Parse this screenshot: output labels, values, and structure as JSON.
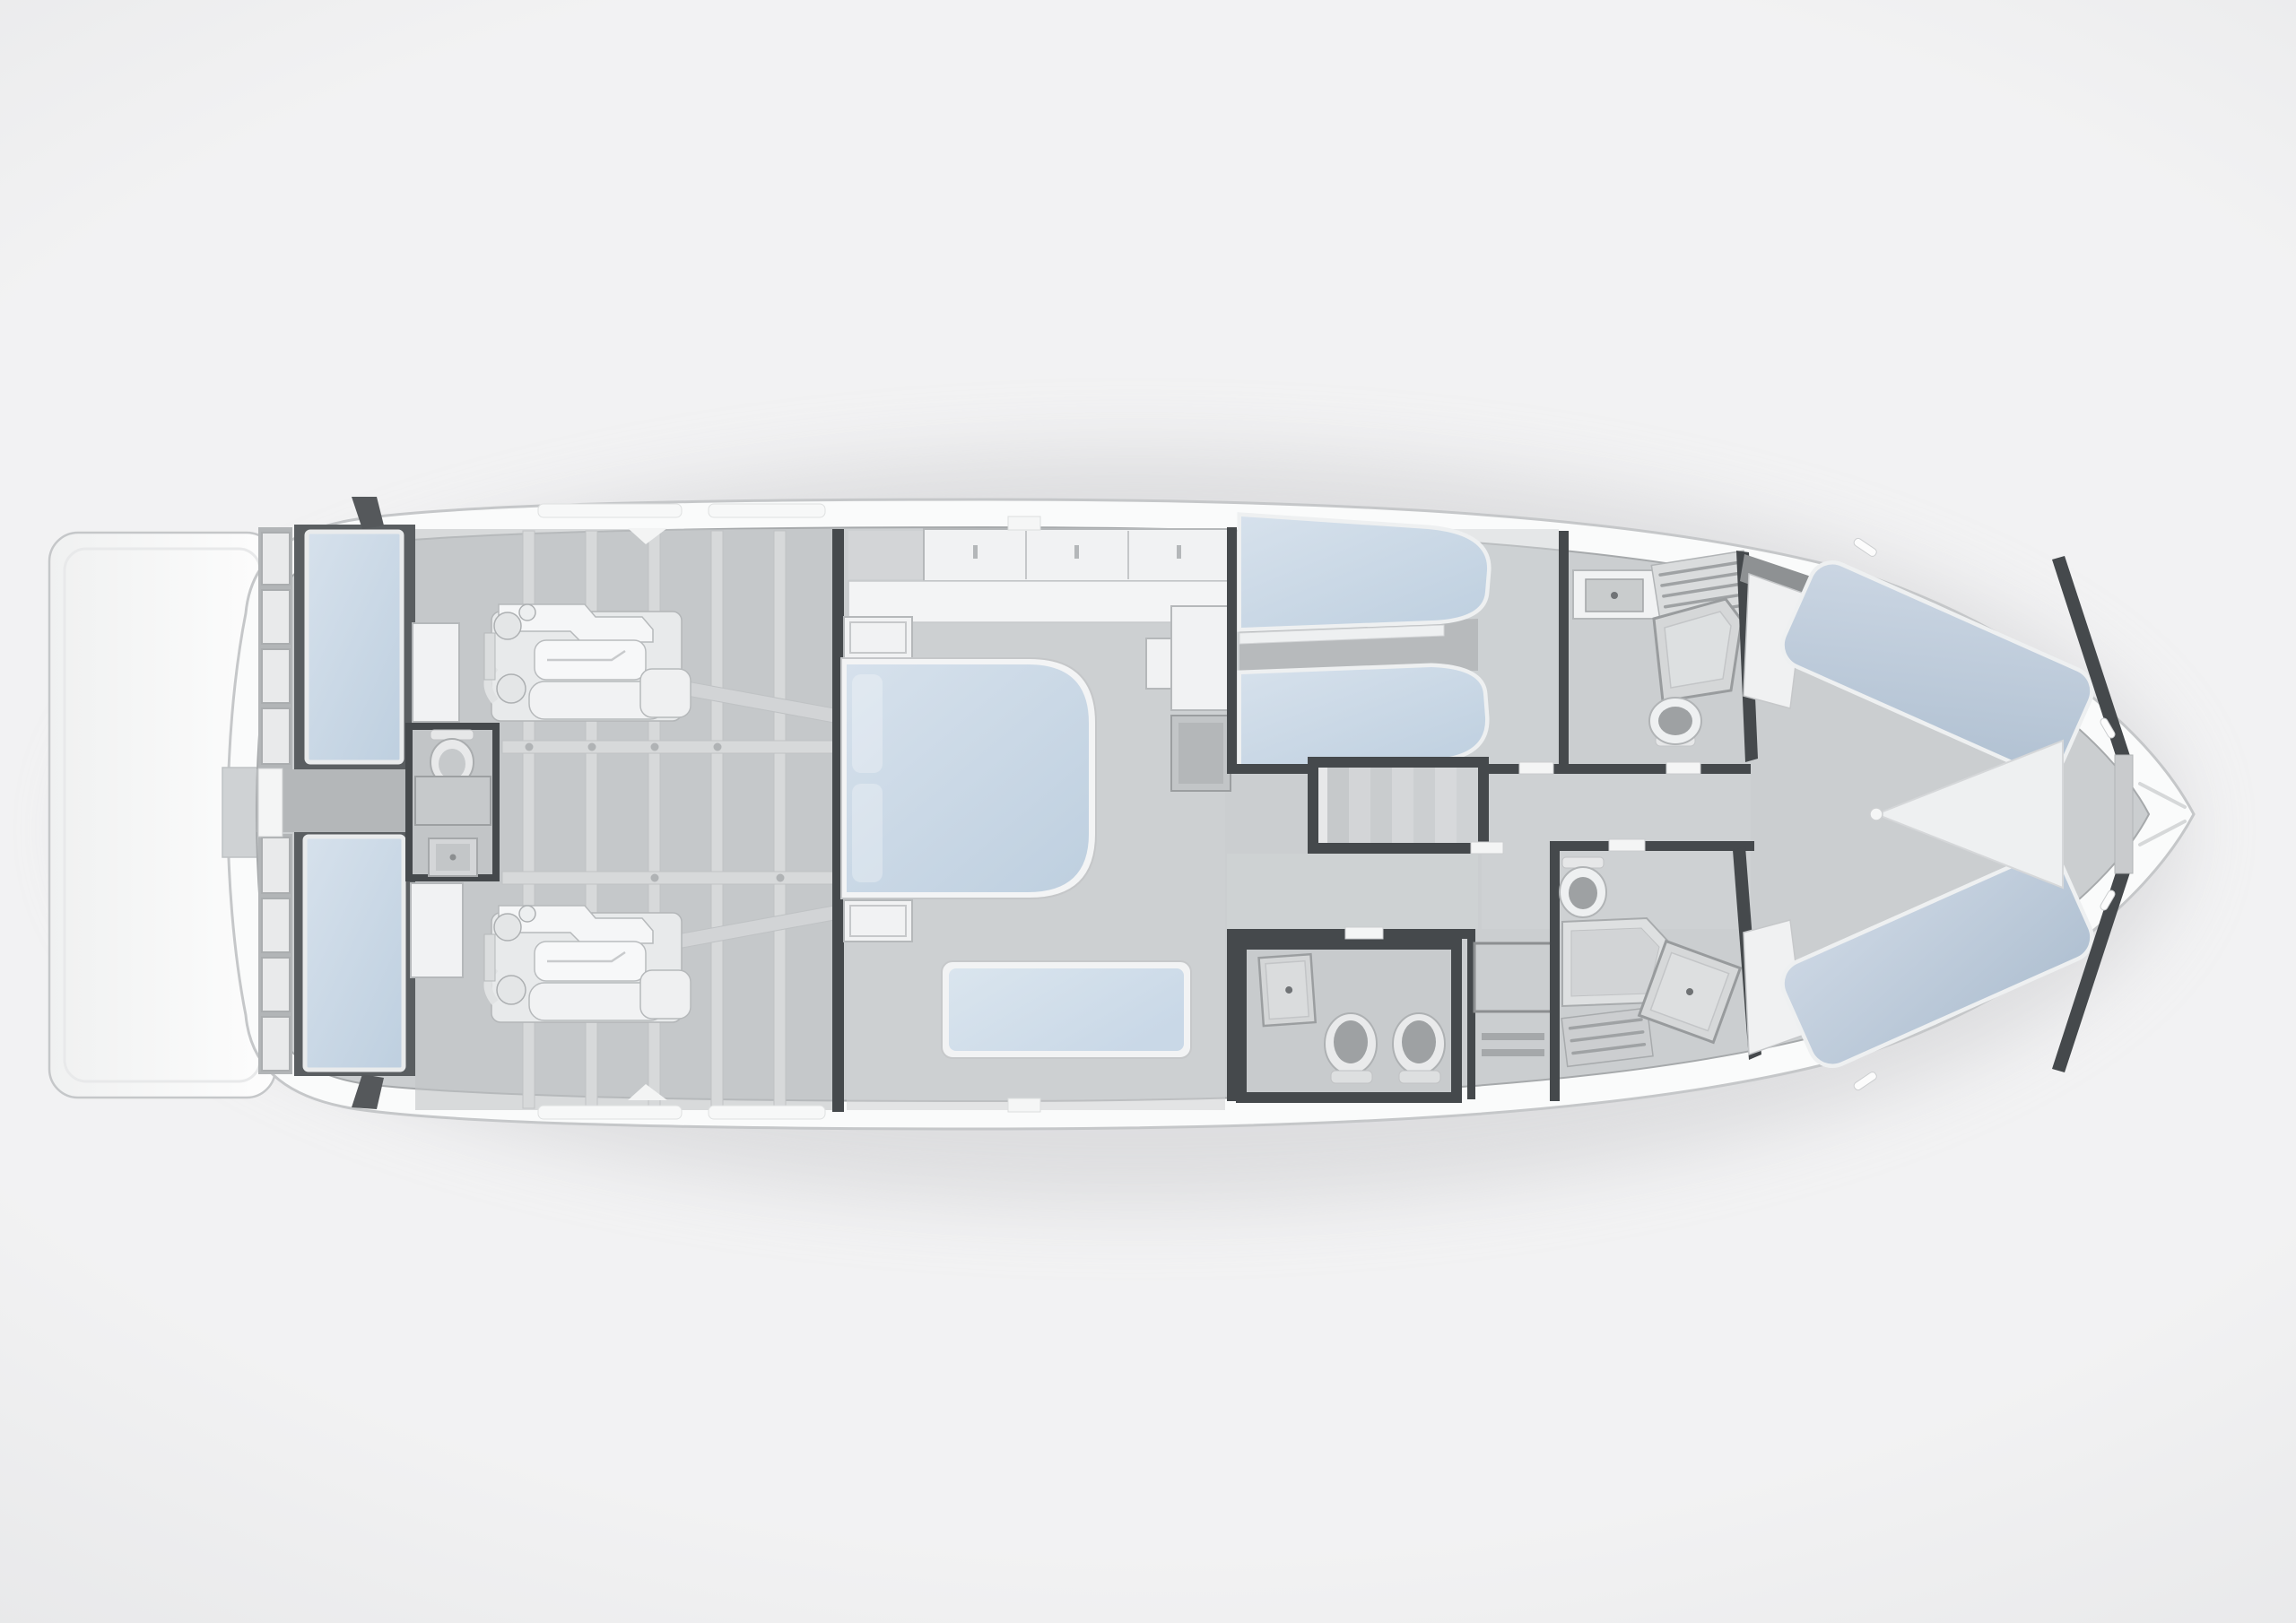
{
  "meta": {
    "title": "Yacht lower deck floor plan — top view",
    "view": "top-down cutaway render",
    "orientation": "bow pointing right, stern (swim platform) at left"
  },
  "palette": {
    "bg-center": "#f2f2f3",
    "bg-edge": "#dbdcde",
    "hull": "#fafbfb",
    "hull-outline": "#c5c7c9",
    "floor": "#cbced0",
    "floor-dark": "#b4b7b9",
    "beam": "#d7d9da",
    "wall": "#45494c",
    "furn": "#f1f2f3",
    "furn-line": "#b5b8ba",
    "door": "#f4f5f5",
    "mat-light": "#d6e1ec",
    "mat-dark": "#bfd0e0",
    "vip-light": "#cbd6e3",
    "vip-dark": "#b2c2d3",
    "sofa-light": "#dae5ee",
    "sofa-dark": "#c9d8e7",
    "fix": "#e9eaeb",
    "fix-dark": "#9ea1a3",
    "shadow": "#cdced0"
  },
  "plan": {
    "stern_to_bow": [
      "swim-platform",
      "crew-area",
      "engine-room",
      "master-cabin",
      "twin-cabin",
      "staircase",
      "corridor",
      "guest-bathroom",
      "utility-compartment",
      "twin-bathroom",
      "vip-bathroom",
      "vip-cabin",
      "forepeak"
    ],
    "rooms": [
      {
        "id": "swim-platform",
        "fixtures": [
          "boarding-walkway"
        ]
      },
      {
        "id": "crew-area",
        "fixtures": [
          "storage-lockers x8",
          "berth-port",
          "berth-starboard",
          "head: toilet, counter, sink",
          "transom-door",
          "side-cabinet x2"
        ]
      },
      {
        "id": "engine-room",
        "fixtures": [
          "engine-port",
          "engine-starboard",
          "prop-shaft x2",
          "structural-grid: 5 frames, 2 stringers"
        ]
      },
      {
        "id": "master-cabin",
        "fixtures": [
          "double-bed",
          "nightstand x2",
          "wardrobe-cabinet-row (3 doors)",
          "dresser-counter",
          "chaise-sofa",
          "wardrobe-column",
          "tv-cabinet",
          "side-table"
        ]
      },
      {
        "id": "twin-cabin",
        "fixtures": [
          "single-bed-outer",
          "single-bed-inner",
          "bed-divider"
        ]
      },
      {
        "id": "twin-bathroom",
        "fixtures": [
          "sink-counter",
          "louvered-cabinet",
          "corner-shower",
          "toilet"
        ]
      },
      {
        "id": "staircase",
        "fixtures": [
          "treads x7",
          "landing"
        ]
      },
      {
        "id": "corridor",
        "fixtures": [
          "door-threshold x4"
        ]
      },
      {
        "id": "guest-bathroom",
        "fixtures": [
          "shower",
          "toilet",
          "bidet"
        ]
      },
      {
        "id": "utility-compartment",
        "fixtures": [
          "storage-chest",
          "vent-louvers x2"
        ]
      },
      {
        "id": "vip-bathroom",
        "fixtures": [
          "toilet",
          "vanity-counter",
          "angled-shower",
          "louvered-cabinet"
        ]
      },
      {
        "id": "vip-cabin",
        "fixtures": [
          "v-berth-port",
          "v-berth-starboard",
          "center-wedge",
          "headboard-panel x2"
        ]
      },
      {
        "id": "forepeak",
        "fixtures": [
          "anchor-locker",
          "bow-seams",
          "mooring-cleat x4"
        ]
      }
    ]
  }
}
